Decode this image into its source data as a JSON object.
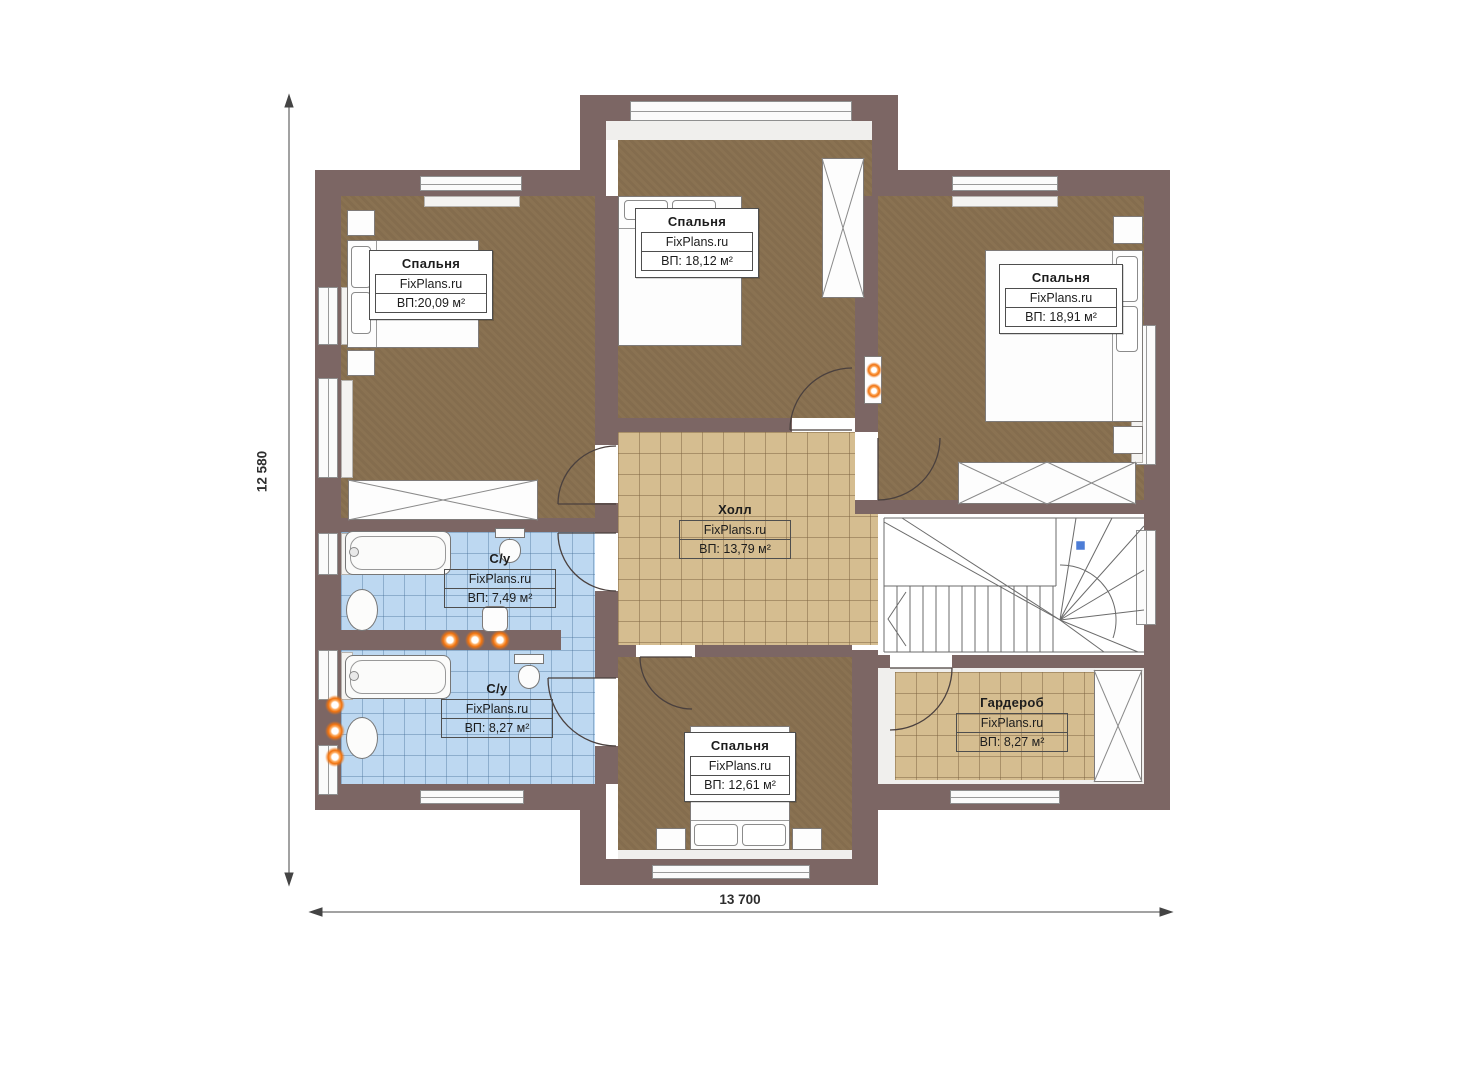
{
  "plan": {
    "title": "floor-plan-second-level",
    "dimensions": {
      "width": "13 700",
      "height": "12 580"
    },
    "rooms": [
      {
        "id": "bedroom-left",
        "name": "Спальня",
        "watermark": "FixPlans.ru",
        "area": "ВП:20,09 м²"
      },
      {
        "id": "bedroom-top",
        "name": "Спальня",
        "watermark": "FixPlans.ru",
        "area": "ВП: 18,12 м²"
      },
      {
        "id": "bedroom-right",
        "name": "Спальня",
        "watermark": "FixPlans.ru",
        "area": "ВП: 18,91 м²"
      },
      {
        "id": "hall",
        "name": "Холл",
        "watermark": "FixPlans.ru",
        "area": "ВП: 13,79 м²"
      },
      {
        "id": "bathroom-1",
        "name": "С/у",
        "watermark": "FixPlans.ru",
        "area": "ВП: 7,49 м²"
      },
      {
        "id": "bathroom-2",
        "name": "С/у",
        "watermark": "FixPlans.ru",
        "area": "ВП: 8,27 м²"
      },
      {
        "id": "bedroom-bottom",
        "name": "Спальня",
        "watermark": "FixPlans.ru",
        "area": "ВП: 12,61 м²"
      },
      {
        "id": "wardrobe",
        "name": "Гардероб",
        "watermark": "FixPlans.ru",
        "area": "ВП: 8,27 м²"
      }
    ],
    "colors": {
      "wall": "#7c6664",
      "bedroom_floor": "#8a7252",
      "hall_floor": "#d5bd90",
      "bath_floor": "#bdd8f1",
      "accent_dot": "#f0720e",
      "stair_marker": "#4d7dd6"
    }
  }
}
